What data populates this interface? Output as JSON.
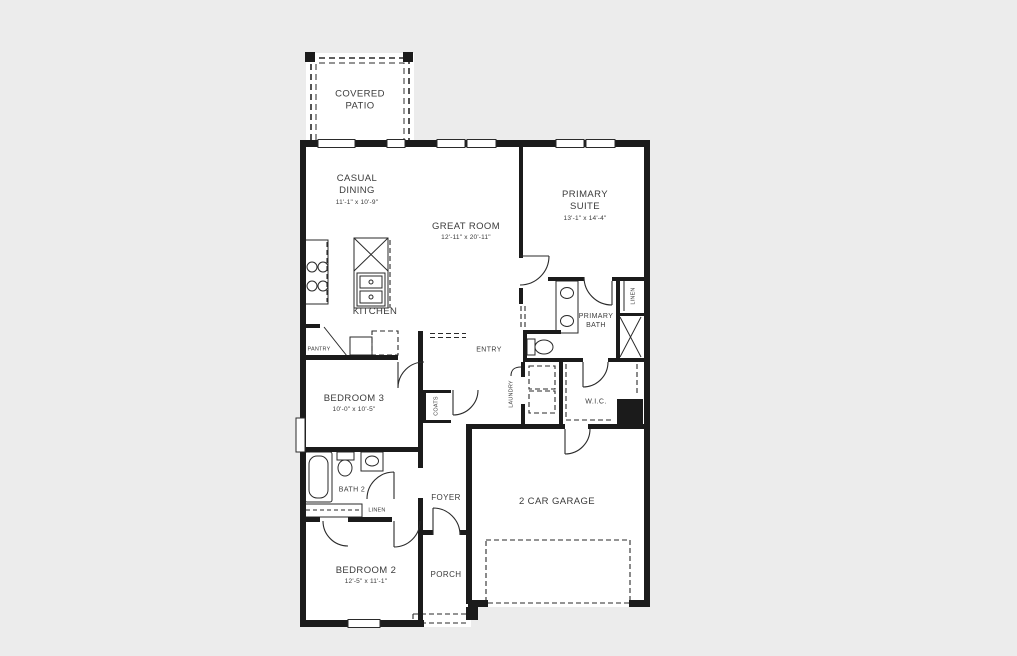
{
  "colors": {
    "background": "#ececec",
    "floor": "#ffffff",
    "wall": "#1b1b1b",
    "line": "#2a2a2a",
    "text": "#3b3b3b"
  },
  "rooms": {
    "covered_patio": {
      "name": "COVERED\nPATIO"
    },
    "casual_dining": {
      "name": "CASUAL\nDINING",
      "dims": "11'-1\" x 10'-9\""
    },
    "great_room": {
      "name": "GREAT ROOM",
      "dims": "12'-11\" x 20'-11\""
    },
    "primary_suite": {
      "name": "PRIMARY\nSUITE",
      "dims": "13'-1\" x 14'-4\""
    },
    "kitchen": {
      "name": "KITCHEN"
    },
    "pantry": {
      "name": "PANTRY"
    },
    "primary_bath": {
      "name": "PRIMARY\nBATH"
    },
    "linen_primary": {
      "name": "LINEN"
    },
    "entry": {
      "name": "ENTRY"
    },
    "laundry": {
      "name": "LAUNDRY"
    },
    "wic": {
      "name": "W.I.C."
    },
    "bedroom3": {
      "name": "BEDROOM 3",
      "dims": "10'-0\" x 10'-5\""
    },
    "coats": {
      "name": "COATS"
    },
    "bath2": {
      "name": "BATH 2"
    },
    "linen_bath2": {
      "name": "LINEN"
    },
    "foyer": {
      "name": "FOYER"
    },
    "garage": {
      "name": "2 CAR GARAGE"
    },
    "bedroom2": {
      "name": "BEDROOM 2",
      "dims": "12'-5\" x 11'-1\""
    },
    "porch": {
      "name": "PORCH"
    }
  }
}
